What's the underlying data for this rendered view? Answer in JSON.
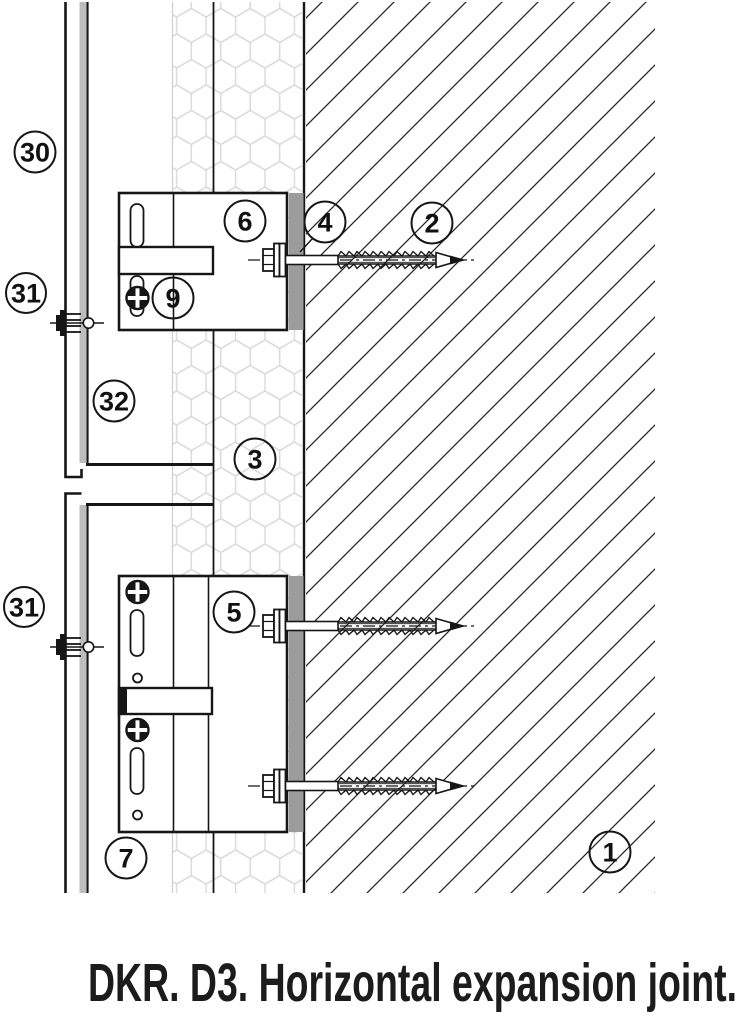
{
  "caption": "DKR. D3. Horizontal expansion joint.",
  "callouts": {
    "c30": {
      "label": "30"
    },
    "c31_upper": {
      "label": "31"
    },
    "c32": {
      "label": "32"
    },
    "c31_lower": {
      "label": "31"
    },
    "c6": {
      "label": "6"
    },
    "c9": {
      "label": "9"
    },
    "c4": {
      "label": "4"
    },
    "c2": {
      "label": "2"
    },
    "c3": {
      "label": "3"
    },
    "c5": {
      "label": "5"
    },
    "c7": {
      "label": "7"
    },
    "c1": {
      "label": "1"
    }
  },
  "colors": {
    "pad_gray": "#9c9c9c",
    "rail_gray": "#bdbdbd",
    "line_black": "#161616"
  }
}
